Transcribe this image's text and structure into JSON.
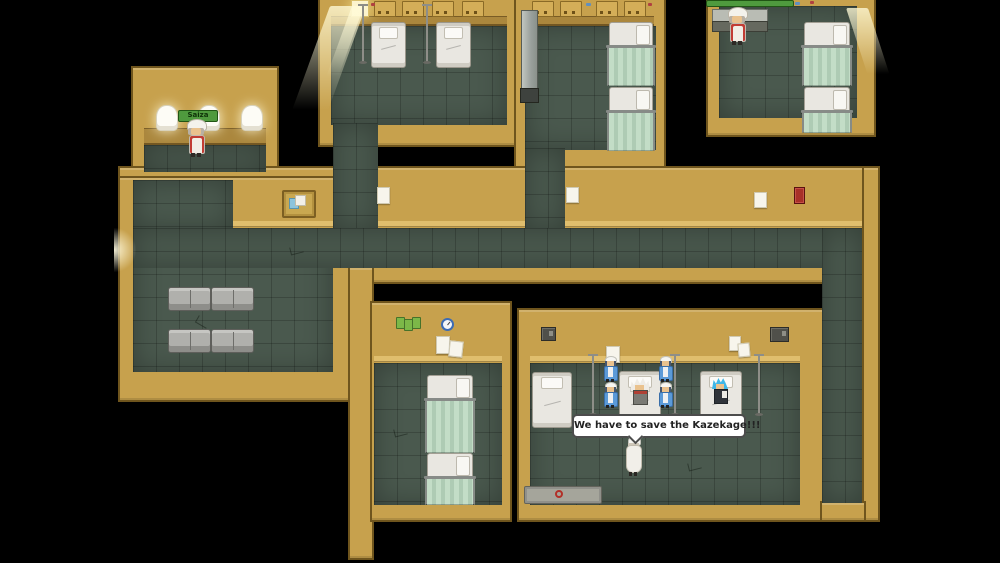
{
  "scene": {
    "type": "rpg-map-screenshot",
    "setting": "hospital interior"
  },
  "dialogue": {
    "text": "We have to save the Kazekage!!!"
  },
  "name_tags": {
    "cafe_attendant": "Saiza"
  },
  "colors": {
    "wall": "#c7a14d",
    "wall-light": "#e3c271",
    "wall-dark": "#6f551d",
    "wall-shade": "#ab873d",
    "floor": "#4a594e",
    "curtain-a": "#c3ddc7",
    "curtain-b": "#aecbb4",
    "bed": "#e9e7e1",
    "sofa": "#b0b0ac",
    "tag-green": "#4f9a3e",
    "uniform-blue": "#5b9ad8",
    "hair-blue": "#3fb7e8",
    "accent-red": "#a83028",
    "bubble-border": "#4c4c4c"
  },
  "inventory": {
    "beds": 11,
    "sofas": 4,
    "iv_poles": 5,
    "standing_nurses": 4,
    "walking_nurses": 1,
    "patients_in_bed": 2,
    "attendants": 2,
    "lamps": 3
  }
}
